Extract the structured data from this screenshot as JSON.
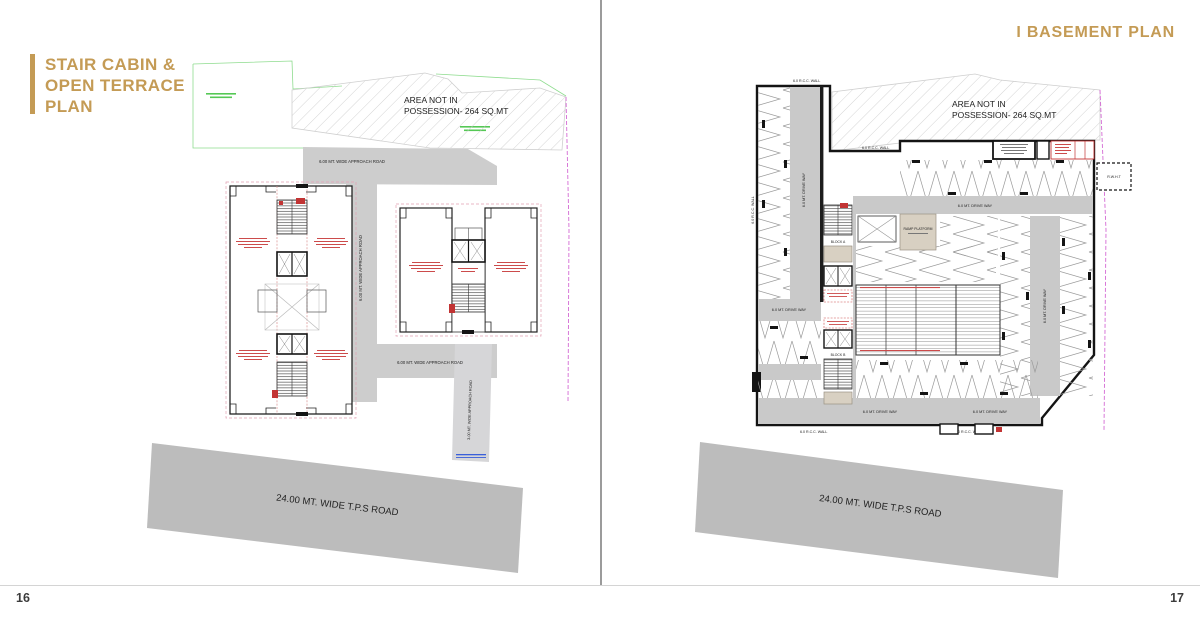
{
  "spread": {
    "left_page_number": "16",
    "right_page_number": "17"
  },
  "left_page": {
    "title_lines": [
      "STAIR CABIN &",
      "OPEN TERRACE",
      "PLAN"
    ],
    "labels": {
      "area_note_1": "AREA NOT IN",
      "area_note_2": "POSSESSION- 264 SQ.MT",
      "approach_road": "6.00 MT. WIDE APPROACH ROAD",
      "approach_road_narrow": "3.00 MT. WIDE APPROACH ROAD",
      "tps_road": "24.00 MT. WIDE T.P.S ROAD"
    }
  },
  "right_page": {
    "title": "I  BASEMENT PLAN",
    "labels": {
      "area_note_1": "AREA NOT IN",
      "area_note_2": "POSSESSION- 264 SQ.MT",
      "tps_road": "24.00 MT. WIDE T.P.S ROAD",
      "drive_way": "6.0 MT. DRIVE WAY",
      "rcc_wall": "6.0 R.C.C. WALL",
      "ramp_platform": "RAMP PLATFORM",
      "block_a": "BLOCK A",
      "block_b": "BLOCK B",
      "rwht": "R.W.H.T"
    }
  },
  "colors": {
    "accent_gold": "#c49b55",
    "road_gray": "#c9c9c9",
    "wall_black": "#141414",
    "plot_green": "#5ecb5e",
    "boundary_magenta": "#d46ad4",
    "detail_red": "#c23434"
  }
}
